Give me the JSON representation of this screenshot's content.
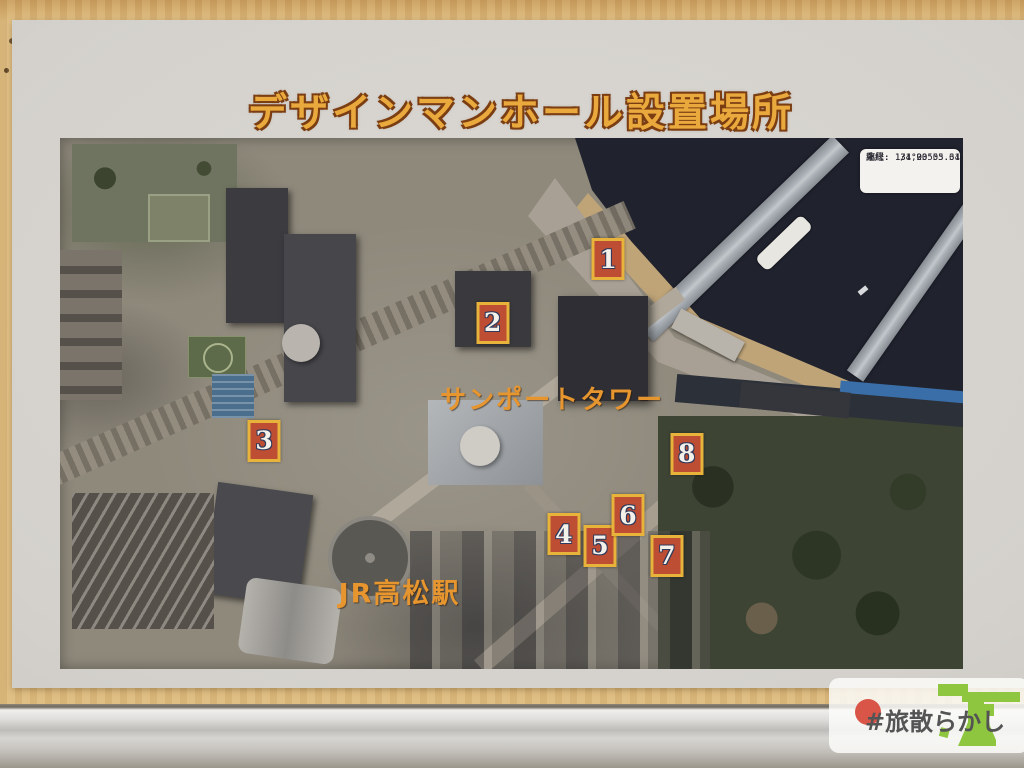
{
  "poster": {
    "title": "デザインマンホール設置場所"
  },
  "map": {
    "info_box": {
      "longitude": "東経: 134°03'03.64\"",
      "latitude": "北緯:  34°20'55.31\"",
      "scale": "縮尺: 1/1,905"
    },
    "labels": {
      "tower": "サンポートタワー",
      "station": "JR高松駅"
    },
    "markers": [
      {
        "label": "1",
        "x": 60.7,
        "y": 22.8
      },
      {
        "label": "2",
        "x": 47.9,
        "y": 34.8
      },
      {
        "label": "3",
        "x": 22.6,
        "y": 57.0
      },
      {
        "label": "4",
        "x": 55.8,
        "y": 74.6
      },
      {
        "label": "5",
        "x": 59.8,
        "y": 76.8
      },
      {
        "label": "6",
        "x": 62.9,
        "y": 71.0
      },
      {
        "label": "7",
        "x": 67.2,
        "y": 78.7
      },
      {
        "label": "8",
        "x": 69.4,
        "y": 59.5
      }
    ],
    "colors": {
      "marker_fill": "#bd4d33",
      "marker_border": "#e7b33b",
      "marker_number": "#f4f1ea",
      "marker_number_outline": "#2f3a5c",
      "label_orange": "#e6952f",
      "water": "#20222e",
      "title_orange": "#eaa93d"
    }
  },
  "watermark": {
    "text": "#旅散らかし",
    "sun_color": "#d85548",
    "logo_color": "#8fc640"
  }
}
